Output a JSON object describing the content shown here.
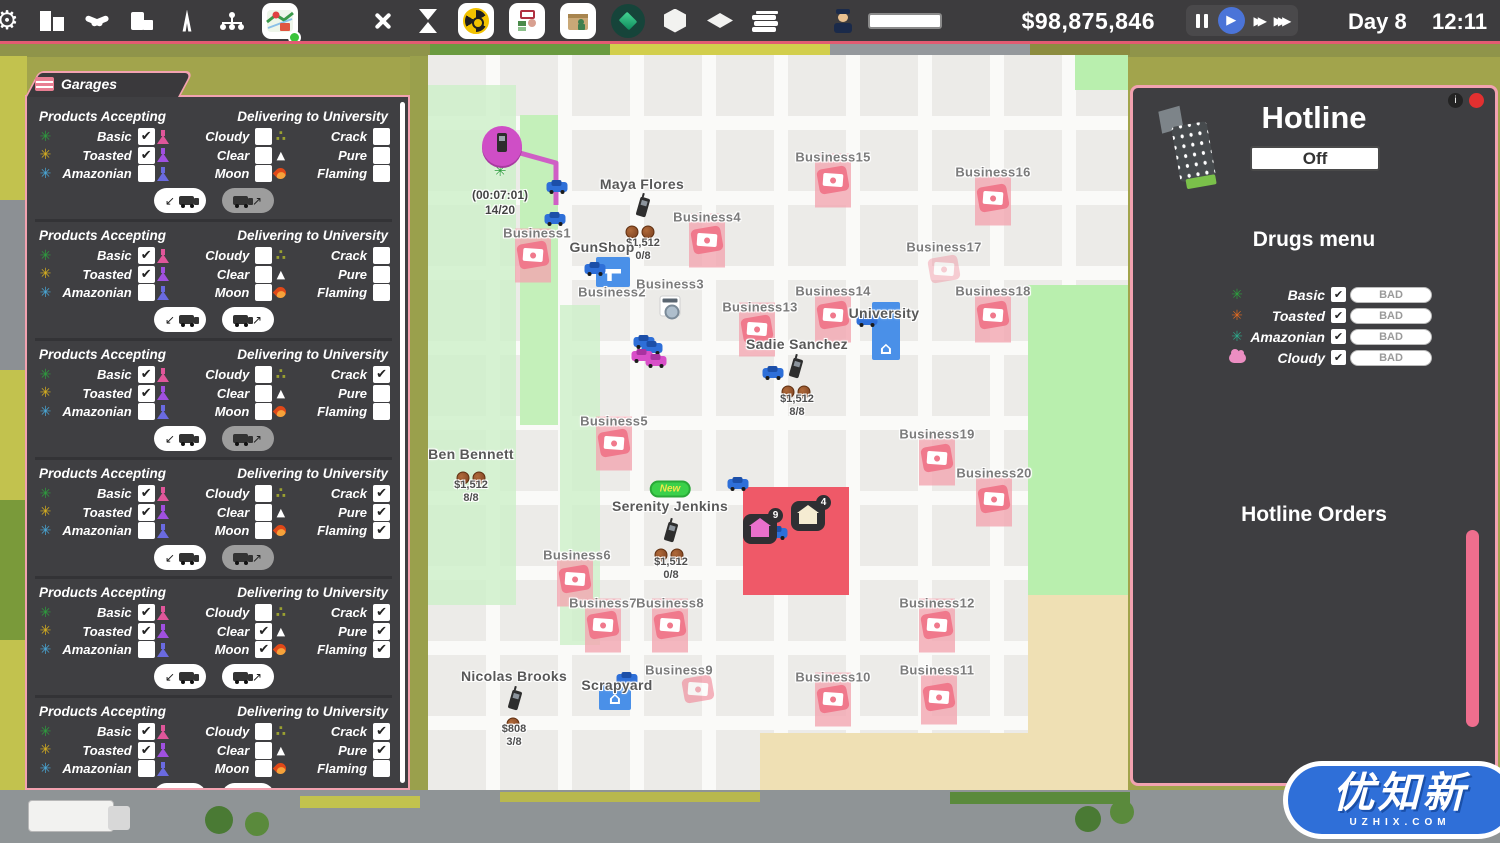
{
  "topbar": {
    "money": "$98,875,846",
    "day_label": "Day 8",
    "time_label": "12:11",
    "icons": [
      "gear-icon",
      "city-buildings-icon",
      "handshake-icon",
      "office-icon",
      "antenna-icon",
      "network-icon",
      "map-icon",
      "utensils-icon",
      "hourglass-icon",
      "radioactive-icon",
      "process-icon",
      "package-icon",
      "gem-icon",
      "cube-icon",
      "tile-icon",
      "books-icon",
      "police-officer-icon"
    ],
    "map_badge_color": "#3bc43b",
    "accent_pink": "#e25b72"
  },
  "garages": {
    "tab_title": "Garages",
    "left_header": "Products Accepting",
    "right_header": "Delivering to University",
    "rows": [
      [
        "basic",
        "cloudy",
        "crack"
      ],
      [
        "toasted",
        "clear",
        "pure"
      ],
      [
        "amazonian",
        "moon",
        "flaming"
      ]
    ],
    "products": [
      {
        "key": "basic",
        "label": "Basic",
        "icon": "leaf",
        "color": "#2e9e3e"
      },
      {
        "key": "toasted",
        "label": "Toasted",
        "icon": "leaf",
        "color": "#d8b020"
      },
      {
        "key": "amazonian",
        "label": "Amazonian",
        "icon": "leaf",
        "color": "#4aa8d8"
      },
      {
        "key": "cloudy",
        "label": "Cloudy",
        "icon": "flask",
        "color": "#e0569a"
      },
      {
        "key": "clear",
        "label": "Clear",
        "icon": "flask",
        "color": "#a050e0"
      },
      {
        "key": "moon",
        "label": "Moon",
        "icon": "flask",
        "color": "#6a6ae0"
      },
      {
        "key": "crack",
        "label": "Crack",
        "icon": "crumbs",
        "color": "#9aa030"
      },
      {
        "key": "pure",
        "label": "Pure",
        "icon": "triangle",
        "color": "#ffffff"
      },
      {
        "key": "flaming",
        "label": "Flaming",
        "icon": "flame",
        "color": "#e04818"
      }
    ],
    "sections": [
      {
        "checked": [
          "basic",
          "toasted"
        ],
        "out_disabled": true
      },
      {
        "checked": [
          "basic",
          "toasted"
        ],
        "out_disabled": false
      },
      {
        "checked": [
          "basic",
          "toasted",
          "crack"
        ],
        "out_disabled": true
      },
      {
        "checked": [
          "basic",
          "toasted",
          "crack",
          "pure",
          "flaming"
        ],
        "out_disabled": true
      },
      {
        "checked": [
          "basic",
          "toasted",
          "clear",
          "moon",
          "crack",
          "pure",
          "flaming"
        ],
        "out_disabled": false
      },
      {
        "checked": [
          "basic",
          "toasted",
          "crack",
          "pure"
        ],
        "out_disabled": false
      }
    ]
  },
  "map": {
    "route": "74,93 128,108 128,232 218,242 218,298",
    "route_color": "#d04fc6",
    "markers": [
      {
        "t": "redzone",
        "n": "danger-zone",
        "x": 315,
        "y": 432,
        "w": 106,
        "h": 108
      },
      {
        "t": "money",
        "n": "business-icon",
        "x": 105,
        "y": 200,
        "b": 1
      },
      {
        "t": "money",
        "n": "business-icon",
        "x": 279,
        "y": 185,
        "b": 1
      },
      {
        "t": "money",
        "n": "business-icon",
        "x": 186,
        "y": 388,
        "b": 1
      },
      {
        "t": "money",
        "n": "business-icon",
        "x": 147,
        "y": 524,
        "b": 1
      },
      {
        "t": "money",
        "n": "business-icon",
        "x": 175,
        "y": 570,
        "b": 1
      },
      {
        "t": "money",
        "n": "business-icon",
        "x": 242,
        "y": 570,
        "b": 1
      },
      {
        "t": "money",
        "n": "business-icon",
        "x": 270,
        "y": 634,
        "o": 0.55
      },
      {
        "t": "money",
        "n": "business-icon",
        "x": 405,
        "y": 644,
        "b": 1
      },
      {
        "t": "money",
        "n": "business-icon",
        "x": 511,
        "y": 642,
        "b": 1
      },
      {
        "t": "money",
        "n": "business-icon",
        "x": 509,
        "y": 570,
        "b": 1
      },
      {
        "t": "money",
        "n": "business-icon",
        "x": 329,
        "y": 274,
        "b": 1
      },
      {
        "t": "money",
        "n": "business-icon",
        "x": 405,
        "y": 260,
        "b": 1
      },
      {
        "t": "money",
        "n": "business-icon",
        "x": 405,
        "y": 125,
        "b": 1
      },
      {
        "t": "money",
        "n": "business-icon",
        "x": 565,
        "y": 143,
        "b": 1
      },
      {
        "t": "money",
        "n": "business-icon",
        "x": 516,
        "y": 214,
        "o": 0.35
      },
      {
        "t": "money",
        "n": "business-icon",
        "x": 565,
        "y": 260,
        "b": 1
      },
      {
        "t": "money",
        "n": "business-icon",
        "x": 509,
        "y": 403,
        "b": 1
      },
      {
        "t": "money",
        "n": "business-icon",
        "x": 566,
        "y": 444,
        "b": 1
      },
      {
        "t": "bluebox",
        "n": "gunshop-icon",
        "x": 185,
        "y": 217,
        "w": 34,
        "h": 30,
        "g": "gun"
      },
      {
        "t": "bluebox",
        "n": "university-icon",
        "x": 458,
        "y": 276,
        "w": 28,
        "h": 58,
        "g": "home"
      },
      {
        "t": "bluebox",
        "n": "scrapyard-icon",
        "x": 187,
        "y": 642,
        "w": 32,
        "h": 26,
        "g": "home"
      },
      {
        "t": "washer",
        "n": "laundromat-icon",
        "x": 242,
        "y": 251
      },
      {
        "t": "start",
        "n": "hotline-hub-icon",
        "x": 74,
        "y": 91
      },
      {
        "t": "leaf",
        "n": "weed-leaf-icon",
        "x": 72,
        "y": 116
      },
      {
        "t": "car",
        "n": "delivery-van",
        "x": 129,
        "y": 131
      },
      {
        "t": "car",
        "n": "delivery-van",
        "x": 127,
        "y": 163
      },
      {
        "t": "car",
        "n": "delivery-van",
        "x": 167,
        "y": 213
      },
      {
        "t": "car",
        "n": "delivery-van",
        "x": 216,
        "y": 286
      },
      {
        "t": "car",
        "n": "delivery-van",
        "x": 224,
        "y": 292
      },
      {
        "t": "car",
        "n": "delivery-van",
        "x": 439,
        "y": 264
      },
      {
        "t": "car",
        "n": "delivery-van",
        "x": 345,
        "y": 317
      },
      {
        "t": "car",
        "n": "delivery-van",
        "x": 310,
        "y": 428
      },
      {
        "t": "car",
        "n": "delivery-van",
        "x": 349,
        "y": 477
      },
      {
        "t": "car",
        "n": "delivery-van",
        "x": 199,
        "y": 623
      },
      {
        "t": "mcar",
        "n": "hotline-van",
        "x": 214,
        "y": 300
      },
      {
        "t": "mcar",
        "n": "hotline-van",
        "x": 228,
        "y": 305
      },
      {
        "t": "house",
        "n": "safehouse-icon",
        "x": 332,
        "y": 474,
        "color": "#e870cc",
        "badge": "9"
      },
      {
        "t": "house",
        "n": "safehouse-icon",
        "x": 380,
        "y": 461,
        "color": "#f5ecd2",
        "badge": "4"
      },
      {
        "t": "phone",
        "n": "customer-phone-icon",
        "x": 215,
        "y": 152
      },
      {
        "t": "phone",
        "n": "customer-phone-icon",
        "x": 368,
        "y": 313
      },
      {
        "t": "phone",
        "n": "customer-phone-icon",
        "x": 243,
        "y": 477
      },
      {
        "t": "phone",
        "n": "customer-phone-icon",
        "x": 87,
        "y": 645
      },
      {
        "t": "coins",
        "n": "coins-icon",
        "x": 212,
        "y": 177,
        "c": 2
      },
      {
        "t": "coins",
        "n": "coins-icon",
        "x": 43,
        "y": 423,
        "c": 2
      },
      {
        "t": "coins",
        "n": "coins-icon",
        "x": 368,
        "y": 337,
        "c": 2
      },
      {
        "t": "coins",
        "n": "coins-icon",
        "x": 241,
        "y": 500,
        "c": 2
      },
      {
        "t": "coins",
        "n": "coins-icon",
        "x": 85,
        "y": 669,
        "c": 1
      },
      {
        "t": "price",
        "n": "customer-price",
        "x": 215,
        "y": 195,
        "l1": "$1,512",
        "l2": "0/8"
      },
      {
        "t": "price",
        "n": "customer-price",
        "x": 43,
        "y": 437,
        "l1": "$1,512",
        "l2": "8/8"
      },
      {
        "t": "price",
        "n": "customer-price",
        "x": 369,
        "y": 351,
        "l1": "$1,512",
        "l2": "8/8"
      },
      {
        "t": "price",
        "n": "customer-price",
        "x": 243,
        "y": 514,
        "l1": "$1,512",
        "l2": "0/8"
      },
      {
        "t": "price",
        "n": "customer-price",
        "x": 86,
        "y": 681,
        "l1": "$808",
        "l2": "3/8"
      },
      {
        "t": "timer",
        "n": "hub-timer",
        "x": 72,
        "y": 148,
        "l1": "(00:07:01)",
        "l2": "14/20"
      },
      {
        "t": "new",
        "n": "new-badge",
        "x": 242,
        "y": 434,
        "text": "New"
      }
    ],
    "labels": [
      {
        "text": "Business1",
        "x": 109,
        "y": 178,
        "k": "biz"
      },
      {
        "text": "Business2",
        "x": 184,
        "y": 237,
        "k": "biz"
      },
      {
        "text": "Business3",
        "x": 242,
        "y": 229,
        "k": "biz"
      },
      {
        "text": "Business4",
        "x": 279,
        "y": 162,
        "k": "biz"
      },
      {
        "text": "Business5",
        "x": 186,
        "y": 366,
        "k": "biz"
      },
      {
        "text": "Business6",
        "x": 149,
        "y": 500,
        "k": "biz"
      },
      {
        "text": "Business7",
        "x": 175,
        "y": 548,
        "k": "biz"
      },
      {
        "text": "Business8",
        "x": 242,
        "y": 548,
        "k": "biz"
      },
      {
        "text": "Business9",
        "x": 251,
        "y": 615,
        "k": "biz"
      },
      {
        "text": "Business10",
        "x": 405,
        "y": 622,
        "k": "biz"
      },
      {
        "text": "Business11",
        "x": 509,
        "y": 615,
        "k": "biz"
      },
      {
        "text": "Business12",
        "x": 509,
        "y": 548,
        "k": "biz"
      },
      {
        "text": "Business13",
        "x": 332,
        "y": 252,
        "k": "biz"
      },
      {
        "text": "Business14",
        "x": 405,
        "y": 236,
        "k": "biz"
      },
      {
        "text": "Business15",
        "x": 405,
        "y": 102,
        "k": "biz"
      },
      {
        "text": "Business16",
        "x": 565,
        "y": 117,
        "k": "biz"
      },
      {
        "text": "Business17",
        "x": 516,
        "y": 192,
        "k": "biz"
      },
      {
        "text": "Business18",
        "x": 565,
        "y": 236,
        "k": "biz"
      },
      {
        "text": "Business19",
        "x": 509,
        "y": 379,
        "k": "biz"
      },
      {
        "text": "Business20",
        "x": 566,
        "y": 418,
        "k": "biz"
      },
      {
        "text": "GunShop",
        "x": 174,
        "y": 192,
        "k": "poi"
      },
      {
        "text": "University",
        "x": 456,
        "y": 258,
        "k": "poi"
      },
      {
        "text": "Scrapyard",
        "x": 189,
        "y": 630,
        "k": "poi"
      },
      {
        "text": "Maya Flores",
        "x": 214,
        "y": 129,
        "k": "person"
      },
      {
        "text": "Sadie Sanchez",
        "x": 369,
        "y": 289,
        "k": "person"
      },
      {
        "text": "Ben Bennett",
        "x": 43,
        "y": 399,
        "k": "person"
      },
      {
        "text": "Serenity Jenkins",
        "x": 242,
        "y": 451,
        "k": "person"
      },
      {
        "text": "Nicolas Brooks",
        "x": 86,
        "y": 621,
        "k": "person"
      }
    ]
  },
  "hotline": {
    "title": "Hotline",
    "toggle_label": "Off",
    "menu_title": "Drugs menu",
    "orders_title": "Hotline Orders",
    "drugs": [
      {
        "label": "Basic",
        "icon": "leaf",
        "color": "#2e9e3e",
        "checked": true,
        "action": "BAD"
      },
      {
        "label": "Toasted",
        "icon": "leaf",
        "color": "#e06a20",
        "checked": true,
        "action": "BAD"
      },
      {
        "label": "Amazonian",
        "icon": "leaf",
        "color": "#2ea88a",
        "checked": true,
        "action": "BAD"
      },
      {
        "label": "Cloudy",
        "icon": "cloud",
        "color": "#ec8ec2",
        "checked": true,
        "action": "BAD"
      }
    ],
    "scrollbar_color": "#ee6e8e"
  },
  "watermark": {
    "text": "优知新",
    "sub": "UZHIX.COM"
  }
}
